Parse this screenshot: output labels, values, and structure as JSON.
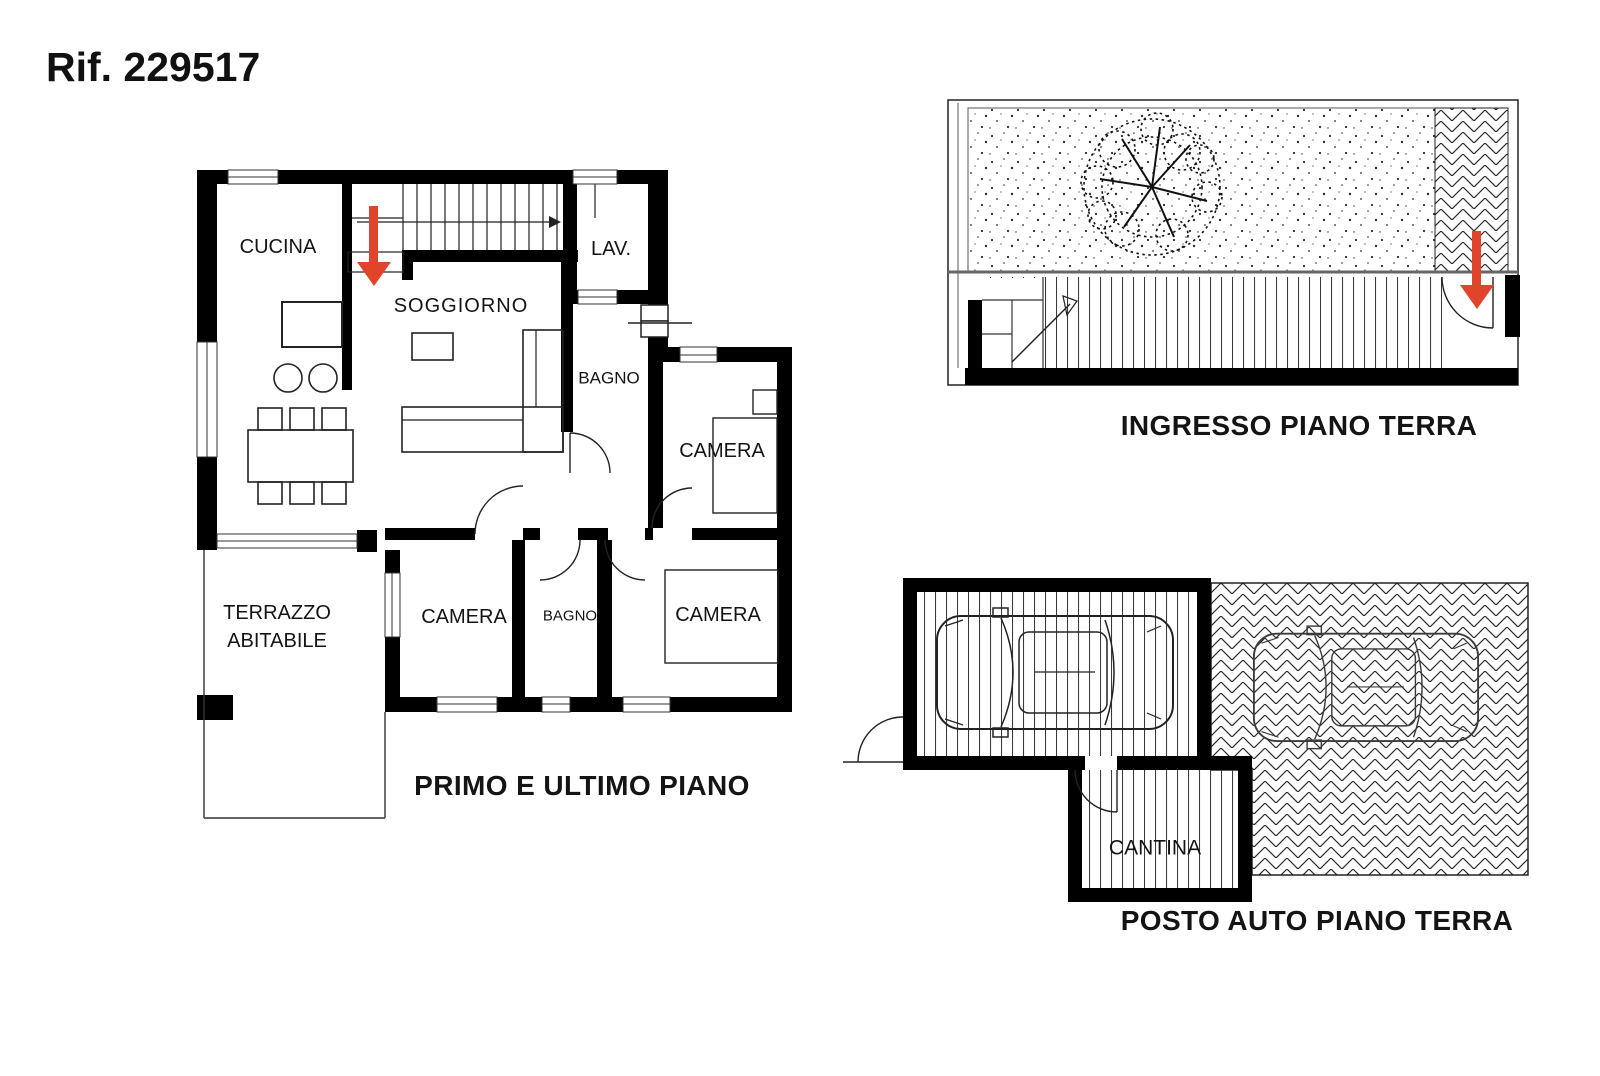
{
  "header": {
    "title": "Rif. 229517"
  },
  "colors": {
    "accent_red": "#e0452c",
    "wall": "#000000"
  },
  "plans": {
    "primo": {
      "label": "PRIMO E ULTIMO PIANO",
      "rooms": {
        "cucina": "CUCINA",
        "soggiorno": "SOGGIORNO",
        "lav": "LAV.",
        "bagno_upper": "BAGNO",
        "camera_ne": "CAMERA",
        "terrazzo_line1": "TERRAZZO",
        "terrazzo_line2": "ABITABILE",
        "camera_sw": "CAMERA",
        "bagno_lower": "BAGNO",
        "camera_se": "CAMERA"
      }
    },
    "ingresso": {
      "label": "INGRESSO PIANO TERRA"
    },
    "posto_auto": {
      "label": "POSTO AUTO PIANO TERRA",
      "rooms": {
        "cantina": "CANTINA"
      }
    }
  }
}
